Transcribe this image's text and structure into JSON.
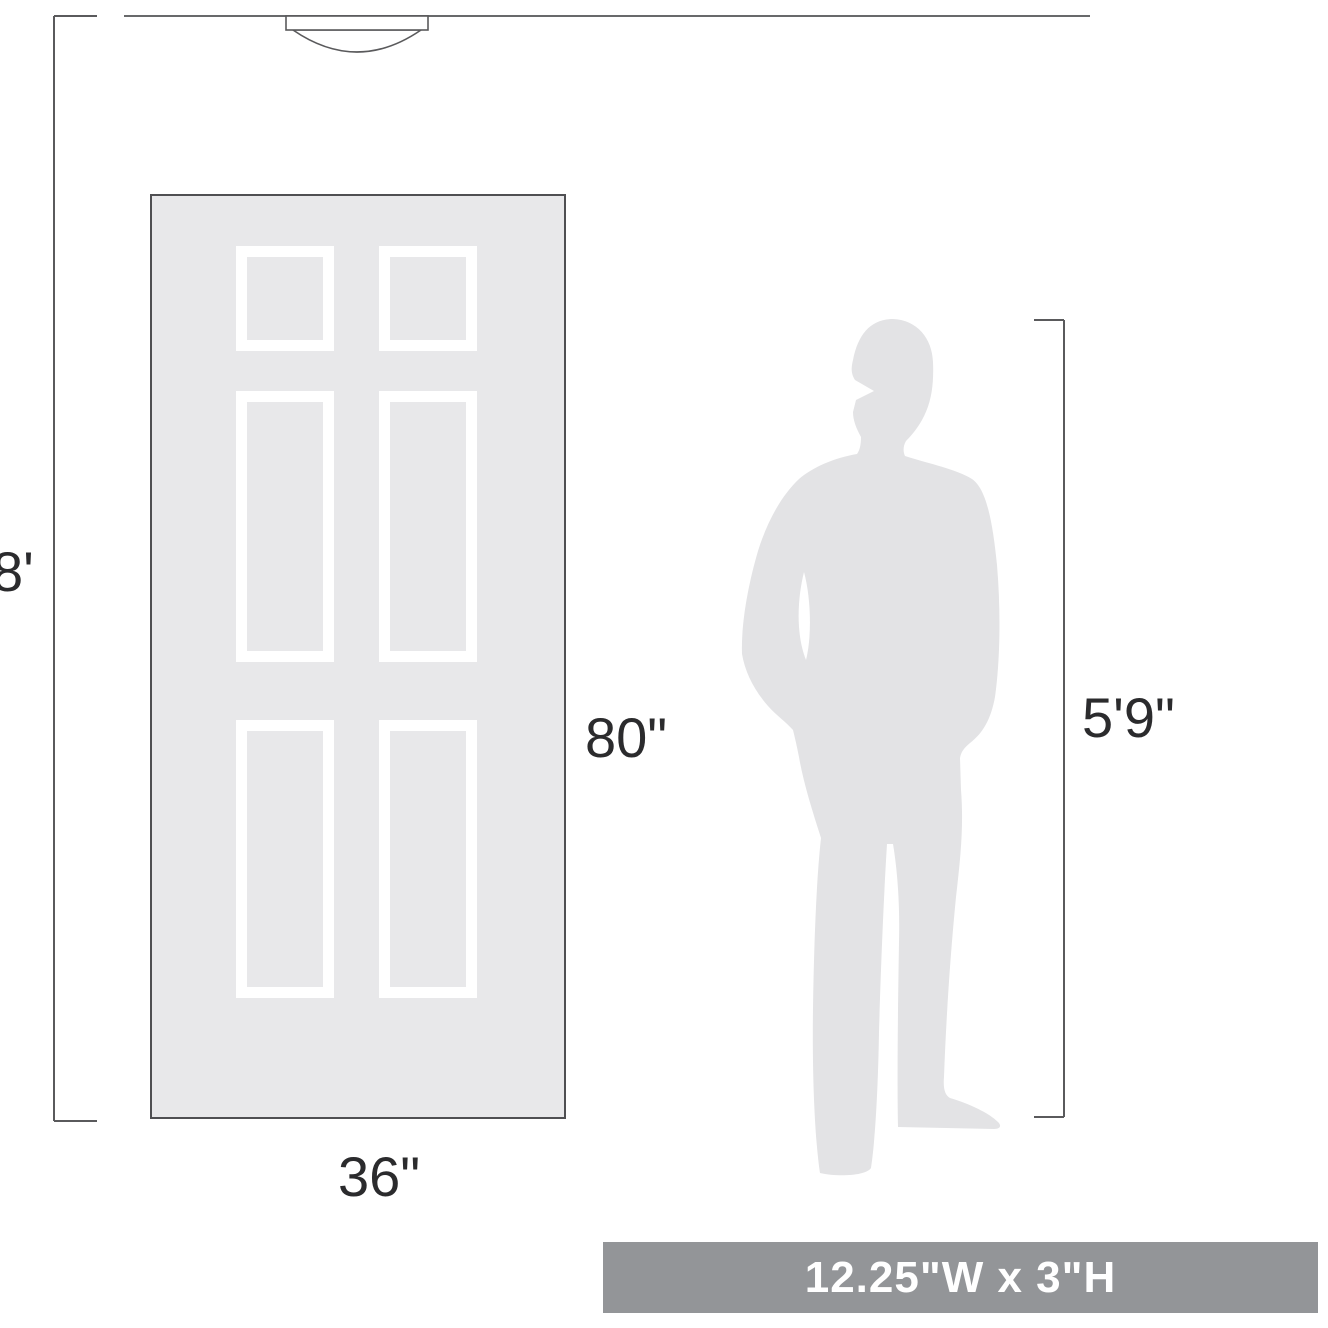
{
  "diagram": {
    "description": "Scale diagram of a flush-mount ceiling light shown against an 8-foot ceiling, a 6-panel door and a human silhouette",
    "ceiling": {
      "height_label": "8'"
    },
    "door": {
      "height_label": "80\"",
      "width_label": "36\"",
      "panel_count": 6
    },
    "person": {
      "height_label": "5'9\""
    },
    "fixture": {
      "size_label": "12.25\"W x 3\"H"
    },
    "colors": {
      "background": "#ffffff",
      "line": "#5a5a5c",
      "ceiling_line": "#68696b",
      "door_fill": "#e8e8ea",
      "door_border": "#4f4f52",
      "panel_frame": "#ffffff",
      "silhouette": "#e3e3e5",
      "badge_bg": "#939598",
      "badge_text": "#ffffff",
      "label_text": "#2b2b2d"
    }
  }
}
